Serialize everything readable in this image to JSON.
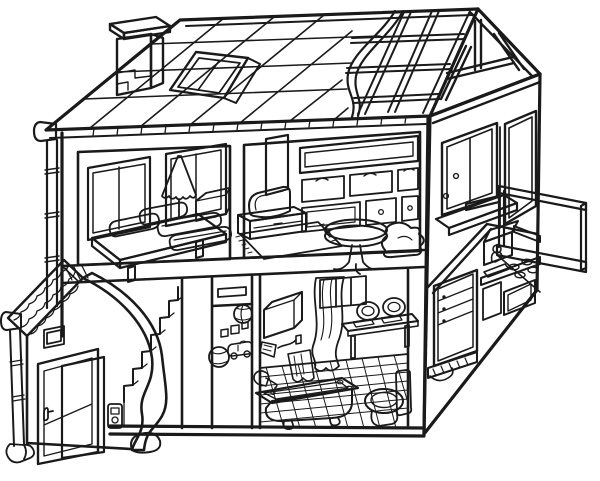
{
  "scene": {
    "title": "Cutaway dollhouse line drawing (coloring page)",
    "style": "black-and-white outline illustration, no text",
    "palette": {
      "line": "#1a1a1a",
      "background": "#ffffff"
    }
  },
  "house": {
    "roof": {
      "left_section": "tiled-roof-grid",
      "right_section": "exposed-rafters-and-purlins",
      "gable": "open-timber-gable-end",
      "features": [
        "chimney",
        "skylight",
        "gutter",
        "downpipe",
        "rolled-edge-between-tiles-and-rafters"
      ]
    },
    "floors": [
      {
        "name": "upper-floor",
        "rooms": [
          {
            "name": "bedroom",
            "objects": [
              "window-two-pane",
              "window-two-pane",
              "floor-lamp-ruffled-shade",
              "platform-bed",
              "pillows",
              "folded-blankets",
              "bedside-cabinet"
            ]
          },
          {
            "name": "living-room",
            "objects": [
              "flat-tv",
              "tv-stand",
              "rug-with-fringe",
              "open-wall-shelf",
              "three-drawers-with-arc-handles",
              "lower-cabinets-with-knobs",
              "round-pedestal-table",
              "beanbag-chair"
            ]
          },
          {
            "name": "balcony-side",
            "objects": [
              "side-window-with-latches",
              "window-sill-ledge",
              "glass-door",
              "balcony-railing",
              "balcony-floor-slab"
            ]
          }
        ]
      },
      {
        "name": "ground-floor",
        "rooms": [
          {
            "name": "entry-porch",
            "objects": [
              "scalloped-tile-awning",
              "porch-gutter-cap",
              "porch-downpipe-with-foot",
              "open-front-door",
              "door-handle",
              "doorbell-panel",
              "small-wall-window"
            ]
          },
          {
            "name": "stair-hall",
            "objects": [
              "staircase",
              "curved-banister-wall",
              "wall-vent-slot"
            ]
          },
          {
            "name": "toy-alcove",
            "objects": [
              "beach-ball",
              "ball",
              "toy-blocks",
              "toy-car"
            ]
          },
          {
            "name": "bathroom",
            "objects": [
              "curtained-window",
              "wall-box-shelf",
              "hand-shower-with-towel",
              "table-with-two-seats",
              "claw-foot-bathtub",
              "tub-faucet",
              "toilet-with-tank",
              "diamond-tiled-floor"
            ]
          },
          {
            "name": "kitchen-corner",
            "objects": [
              "fridge-with-drawers",
              "cooker-hood",
              "wall-shelf",
              "sink-with-faucet",
              "four-burner-cooktop",
              "oven",
              "hatched-base-band"
            ]
          }
        ]
      }
    ]
  }
}
